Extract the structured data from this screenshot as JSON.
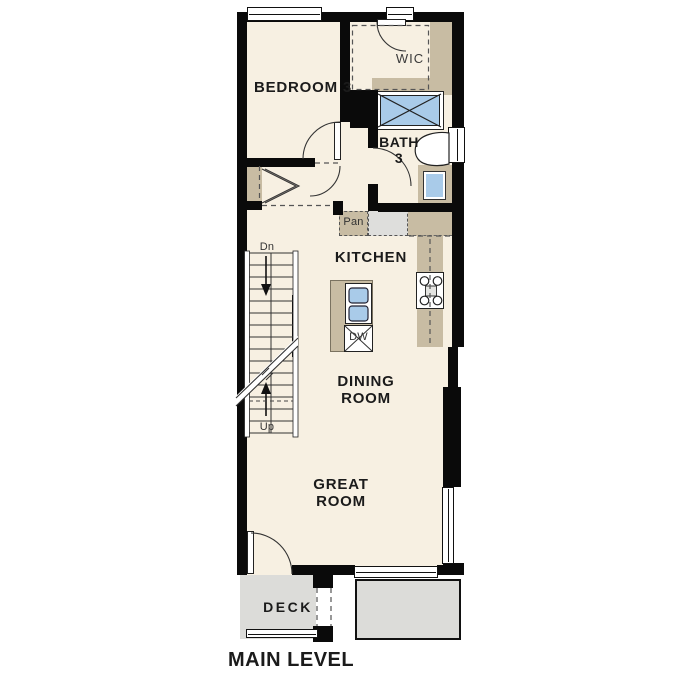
{
  "title": "MAIN LEVEL",
  "labels": {
    "bedroom3": "BEDROOM 3",
    "wic": "WIC",
    "bath3": "BATH 3",
    "kitchen": "KITCHEN",
    "pantry": "Pan",
    "dishwasher": "DW",
    "dining_room": "DINING ROOM",
    "great_room": "GREAT ROOM",
    "deck": "DECK",
    "stairs_down": "Dn",
    "stairs_up": "Up"
  },
  "colors": {
    "floor": "#F7F0E2",
    "wall": "#0a0a0a",
    "cabinetry": "#C8BCA3",
    "plumbing_fixture": "#A9CBE9",
    "deck_surface": "#DCDCD9",
    "linework": "#2a2a2a"
  }
}
